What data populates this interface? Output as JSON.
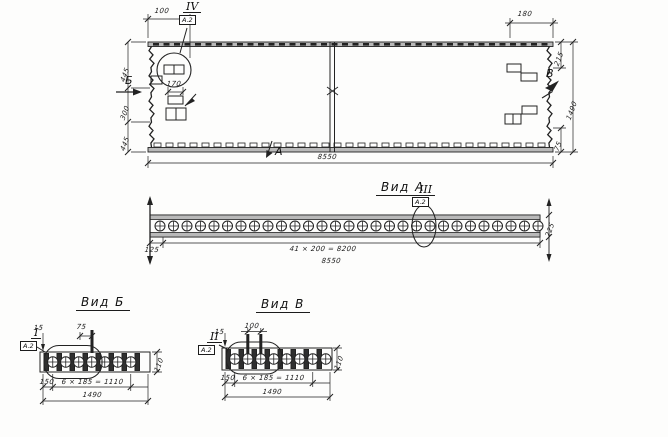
{
  "drawing": {
    "plan": {
      "callout_numeral": "IV",
      "callout_sheet": "А.2",
      "dim_top_left": "100",
      "dim_top_right": "180",
      "dim_left_top": "445",
      "dim_left_mid": "300",
      "dim_left_bottom": "445",
      "dim_right_top": "215",
      "dim_right_bottom": "75",
      "dim_right_total": "1490",
      "dim_plate": "170",
      "dim_total": "8550",
      "marker_left": "Б",
      "marker_right": "В",
      "marker_bottom": "А"
    },
    "view_a": {
      "title": "Вид А",
      "callout_numeral": "III",
      "callout_sheet": "А.2",
      "dim_left": "125",
      "dim_spacing": "41 × 200 = 8200",
      "dim_total": "8550",
      "dim_end": "225"
    },
    "view_b": {
      "title": "Вид Б",
      "callout_numeral": "I",
      "callout_sheet": "А.2",
      "dim_edge": "15",
      "dim_pin": "75",
      "dim_height": "110",
      "dim_first": "150",
      "dim_spacing": "6 × 185 = 1110",
      "dim_total": "1490"
    },
    "view_v": {
      "title": "Вид В",
      "callout_numeral": "II",
      "callout_sheet": "А.2",
      "dim_edge": "15",
      "dim_pins": "100",
      "dim_height": "110",
      "dim_first": "150",
      "dim_spacing": "6 × 185 = 1110",
      "dim_total": "1490"
    }
  }
}
